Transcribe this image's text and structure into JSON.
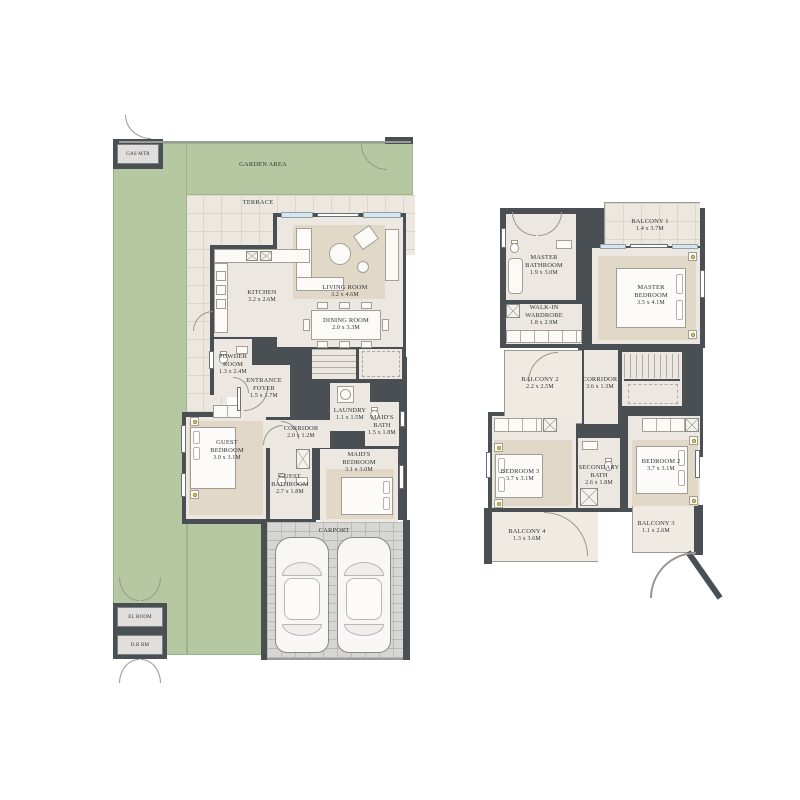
{
  "ground_floor": {
    "areas": {
      "gas_meter": "GAS MTR",
      "garden": "GARDEN AREA",
      "terrace": "TERRACE",
      "carport": "CARPORT",
      "el_room": "EL ROOM",
      "db_room": "D.B RM"
    },
    "kitchen": {
      "name": "KITCHEN",
      "dims": "3.2 x 2.6M"
    },
    "living": {
      "name": "LIVING ROOM",
      "dims": "3.2 x 4.6M"
    },
    "dining": {
      "name": "DINING ROOM",
      "dims": "2.0 x 3.3M"
    },
    "powder": {
      "name": "POWDER ROOM",
      "dims": "1.3 x 2.4M"
    },
    "foyer": {
      "name": "ENTRANCE FOYER",
      "dims": "1.5 x 1.7M"
    },
    "laundry": {
      "name": "LAUNDRY",
      "dims": "1.1 x 1.5M"
    },
    "corridor": {
      "name": "CORRIDOR",
      "dims": "2.0 x 1.2M"
    },
    "maids_bath": {
      "name": "MAID'S BATH",
      "dims": "1.5 x 1.8M"
    },
    "maids_bedroom": {
      "name": "MAID'S BEDROOM",
      "dims": "3.1 x 3.0M"
    },
    "guest_bedroom": {
      "name": "GUEST BEDROOM",
      "dims": "3.0 x 3.1M"
    },
    "guest_bathroom": {
      "name": "GUEST BATHROOM",
      "dims": "2.7 x 1.8M"
    }
  },
  "first_floor": {
    "balcony1": {
      "name": "BALCONY 1",
      "dims": "1.4 x 3.7M"
    },
    "master_bathroom": {
      "name": "MASTER BATHROOM",
      "dims": "1.9 x 3.0M"
    },
    "walk_in_wardrobe": {
      "name": "WALK-IN WARDROBE",
      "dims": "1.8 x 2.9M"
    },
    "master_bedroom": {
      "name": "MASTER BEDROOM",
      "dims": "3.5 x 4.1M"
    },
    "balcony2": {
      "name": "BALCONY 2",
      "dims": "2.2 x 2.5M"
    },
    "corridor": {
      "name": "CORRIDOR",
      "dims": "3.6 x 1.3M"
    },
    "bedroom3": {
      "name": "BEDROOM 3",
      "dims": "3.7 x 3.1M"
    },
    "secondary_bath": {
      "name": "SECONDARY BATH",
      "dims": "2.6 x 1.8M"
    },
    "bedroom2": {
      "name": "BEDROOM 2",
      "dims": "3.7 x 3.1M"
    },
    "balcony4": {
      "name": "BALCONY 4",
      "dims": "1.3 x 3.6M"
    },
    "balcony3": {
      "name": "BALCONY 3",
      "dims": "1.1 x 2.6M"
    }
  },
  "colors": {
    "wall": "#4a4f54",
    "garden_green": "#b6c8a2",
    "floor_beige": "#ece8e1",
    "carport_grey": "#d6d6d4",
    "label_text": "#33353a",
    "lamp_yellow": "#e7df6d"
  }
}
